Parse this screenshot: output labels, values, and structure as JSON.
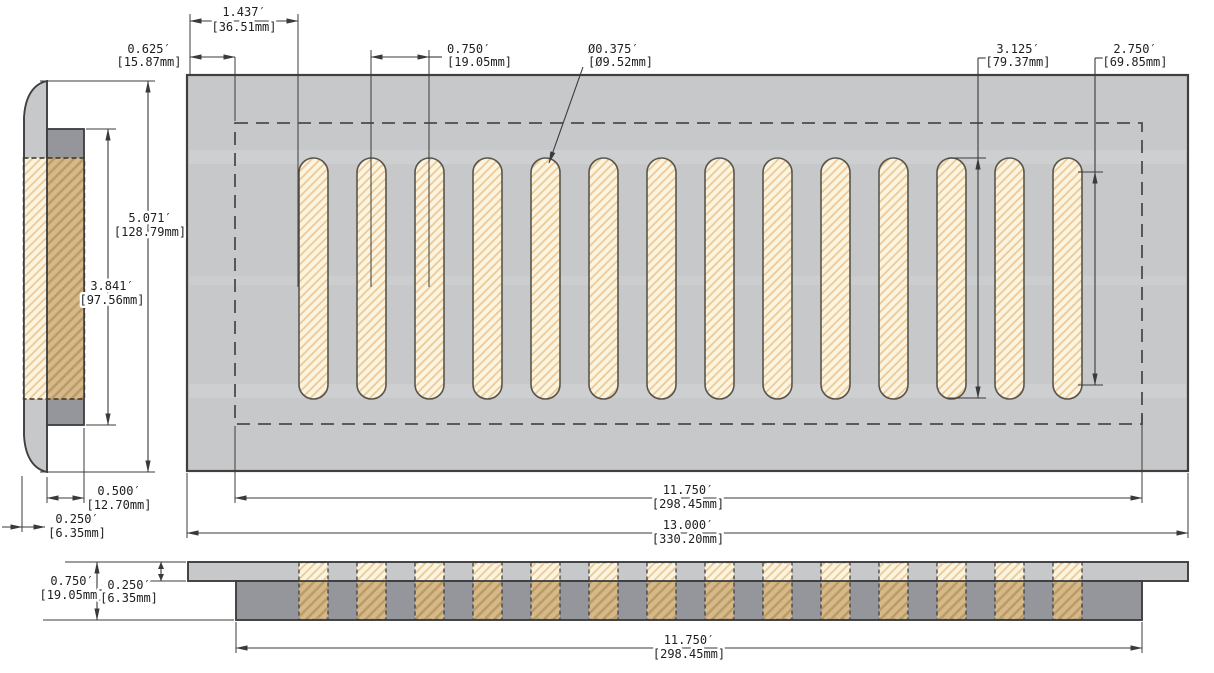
{
  "drawing": {
    "type": "technical-dimension-drawing",
    "slot_count": 14,
    "colors": {
      "plate_gray": "#c7c8ca",
      "dark_gray": "#95969b",
      "hatch_cream_bg": "#fbf4de",
      "hatch_cream_line": "#ecc795",
      "hatch_tan_bg": "#d5b98a",
      "hatch_tan_line": "#bb9b64",
      "line_dark": "#3a3a3a"
    },
    "dims": {
      "edge_to_slot": {
        "in": "1.437′",
        "mm": "[36.51mm]"
      },
      "border_inset": {
        "in": "0.625′",
        "mm": "[15.87mm]"
      },
      "slot_pitch": {
        "in": "0.750′",
        "mm": "[19.05mm]"
      },
      "slot_dia": {
        "in": "Ø0.375′",
        "mm": "[Ø9.52mm]"
      },
      "slot_overall": {
        "in": "3.125′",
        "mm": "[79.37mm]"
      },
      "slot_straight": {
        "in": "2.750′",
        "mm": "[69.85mm]"
      },
      "plate_height": {
        "in": "5.071′",
        "mm": "[128.79mm]"
      },
      "box_height": {
        "in": "3.841′",
        "mm": "[97.56mm]"
      },
      "box_depth": {
        "in": "0.500′",
        "mm": "[12.70mm]"
      },
      "plate_thick": {
        "in": "0.250′",
        "mm": "[6.35mm]"
      },
      "total_depth": {
        "in": "0.750′",
        "mm": "[19.05mm]"
      },
      "face_thick": {
        "in": "0.250′",
        "mm": "[6.35mm]"
      },
      "box_width": {
        "in": "11.750′",
        "mm": "[298.45mm]"
      },
      "plate_width": {
        "in": "13.000′",
        "mm": "[330.20mm]"
      },
      "box_width_front": {
        "in": "11.750′",
        "mm": "[298.45mm]"
      }
    }
  }
}
